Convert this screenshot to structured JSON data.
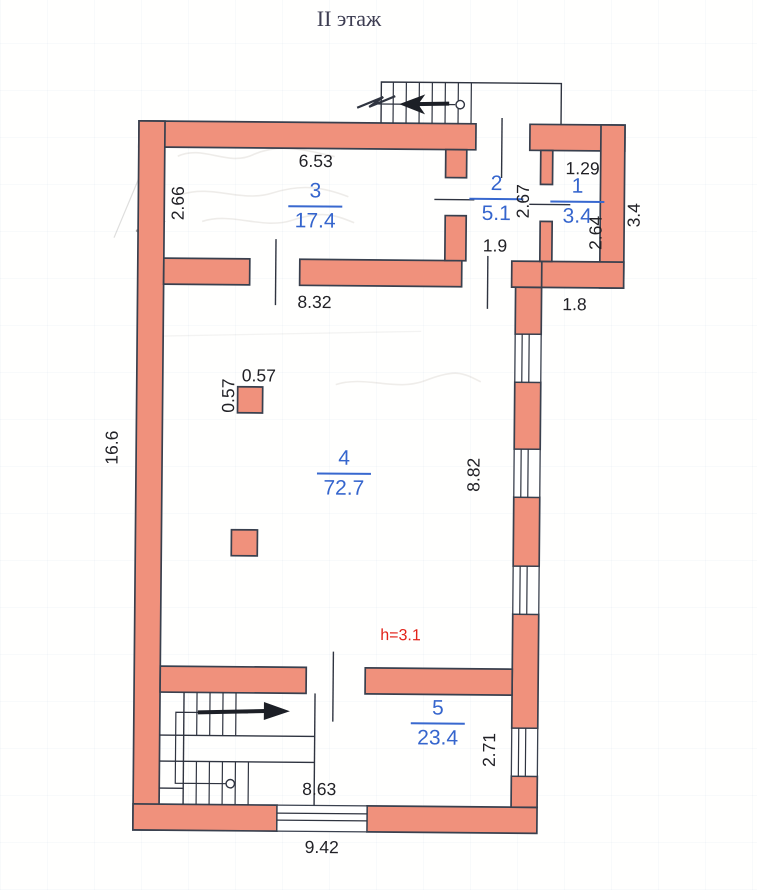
{
  "title": "II этаж",
  "plan": {
    "rooms": [
      {
        "number": "1",
        "area": "3.4"
      },
      {
        "number": "2",
        "area": "5.1"
      },
      {
        "number": "3",
        "area": "17.4"
      },
      {
        "number": "4",
        "area": "72.7"
      },
      {
        "number": "5",
        "area": "23.4"
      }
    ],
    "dimensions": {
      "room3_width": "6.53",
      "room3_depth": "2.66",
      "room2_depth": "2.67",
      "room2_bottom": "1.9",
      "room1_width": "1.29",
      "room1_depth": "2.64",
      "annex_right_side": "3.4",
      "hall_top_width": "8.32",
      "annex_offset": "1.8",
      "left_side": "16.6",
      "column_width": "0.57",
      "column_depth": "0.57",
      "hall_right_depth": "8.82",
      "room5_right_depth": "2.71",
      "room5_width": "8.63",
      "bottom_width": "9.42"
    },
    "ceiling_height_note": "h=3.1",
    "colors": {
      "wall_fill": "#f0917c",
      "outline": "#39404e",
      "room_label": "#3565cd",
      "dimension_text": "#212126",
      "height_note": "#e2231a"
    }
  }
}
